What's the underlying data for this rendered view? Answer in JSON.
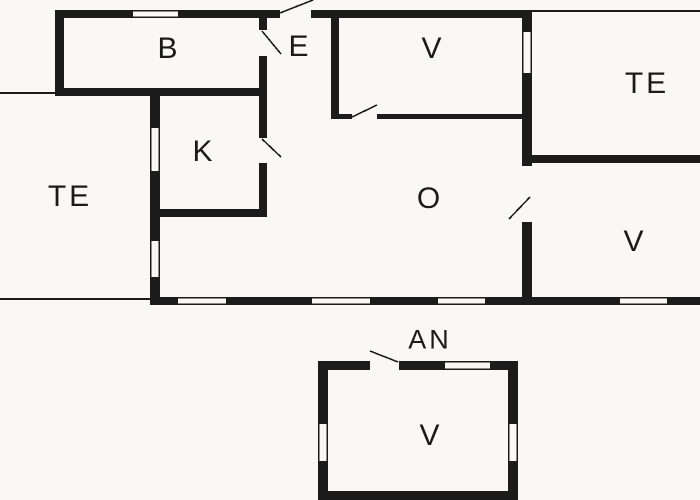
{
  "colors": {
    "background": "#f9f8f4",
    "wall": "#1c1c1c",
    "text": "#1a1a1a"
  },
  "rooms": {
    "b": {
      "label": "B"
    },
    "e": {
      "label": "E"
    },
    "v_top": {
      "label": "V"
    },
    "te_right": {
      "label": "TE"
    },
    "te_left": {
      "label": "TE"
    },
    "k": {
      "label": "K"
    },
    "o": {
      "label": "O"
    },
    "v_right": {
      "label": "V"
    },
    "an": {
      "label": "AN"
    },
    "v_annex": {
      "label": "V"
    }
  }
}
